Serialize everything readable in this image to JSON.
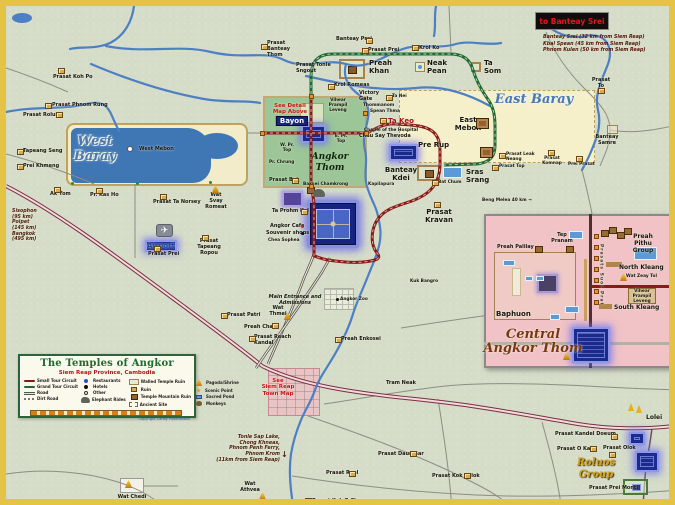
{
  "title": "The Temples of Angkor",
  "colors": {
    "frame": "#e5c345",
    "map_bg": "#d5dcc8",
    "river": "#4d7fc4",
    "baray_water": "#3f76b4",
    "baray_dry": "#f2ecca",
    "thom_green": "#9cc697",
    "highlight_blue": "#1b2a8f",
    "highlight_glow": "#8f97e8",
    "small_circuit": "#8a1a1a",
    "grand_circuit": "#1f6b35",
    "highway": "#7a3040",
    "road": "#8a8f82",
    "inset_pink": "#f1c3c6",
    "legend_green": "#2a6437",
    "red_text": "#cc1515"
  },
  "legend": {
    "title": "The Temples of Angkor",
    "subtitle": "Siem Reap Province, Cambodia",
    "copyright": "Copyright Canby Publications",
    "columns": [
      [
        {
          "i": "line-red",
          "l": "Small Tour Circuit"
        },
        {
          "i": "line-green",
          "l": "Grand Tour Circuit"
        },
        {
          "i": "line-road",
          "l": "Road"
        },
        {
          "i": "line-dirt",
          "l": "Dirt Road"
        }
      ],
      [
        {
          "i": "dot-blue",
          "l": "Restaurants"
        },
        {
          "i": "dot-black",
          "l": "Hotels"
        },
        {
          "i": "circle",
          "l": "Other"
        },
        {
          "i": "eleph",
          "l": "Elephant Rides"
        }
      ],
      [
        {
          "i": "walled",
          "l": "Walled Temple Ruin"
        },
        {
          "i": "ruin",
          "l": "Ruin"
        },
        {
          "i": "temple",
          "l": "Temple Mountain Ruin"
        },
        {
          "i": "site",
          "l": "Ancient Site"
        }
      ],
      [
        {
          "i": "pagoda",
          "l": "Pagoda/Shrine"
        },
        {
          "i": "star",
          "l": "Scenic Point"
        },
        {
          "i": "pond",
          "l": "Sacred Pond"
        },
        {
          "i": "monkey",
          "l": "Monkeys"
        }
      ]
    ]
  },
  "banteay_srei": {
    "title": "to Banteay Srei",
    "notes": [
      "Banteay Srei (32 km from Siem Reap)",
      "Kbal Spean (45 km from Siem Reap)",
      "Phnom Kulen (50 km from Siem Reap)"
    ]
  },
  "map": {
    "labels": [
      {
        "x": 89,
        "y": 128,
        "t": "West\nBaray",
        "c": "region ctr",
        "n": "west-baray-label"
      },
      {
        "x": 528,
        "y": 86,
        "t": "East Baray",
        "c": "region ctr",
        "n": "east-baray-label"
      },
      {
        "x": 324,
        "y": 146,
        "t": "Angkor\nThom",
        "c": "thom ctr",
        "n": "angkor-thom-label"
      },
      {
        "x": 527,
        "y": 322,
        "t": "Central\nAngkor Thom",
        "c": "script ctr",
        "n": "central-angkor-thom-title"
      },
      {
        "x": 590,
        "y": 451,
        "t": "Roluos\nGroup",
        "c": "goldscript ctr",
        "n": "roluos-group-label"
      },
      {
        "x": 286,
        "y": 110,
        "t": "Bayon",
        "c": "chip ctr",
        "n": "bayon-label"
      },
      {
        "x": 284,
        "y": 97,
        "t": "See Detail\nMap Above",
        "c": "red ctr",
        "n": "see-detail-note"
      },
      {
        "x": 272,
        "y": 372,
        "t": "See\nSiem Reap\nTown Map",
        "c": "red ctr",
        "n": "see-town-map-note"
      },
      {
        "x": 382,
        "y": 111,
        "t": "Ta Keo",
        "c": "redbold"
      },
      {
        "x": 363,
        "y": 53,
        "t": "Preah\nKhan",
        "c": "bold"
      },
      {
        "x": 421,
        "y": 53,
        "t": "Neak\nPean",
        "c": "bold"
      },
      {
        "x": 478,
        "y": 53,
        "t": "Ta\nSom",
        "c": "bold"
      },
      {
        "x": 462,
        "y": 110,
        "t": "East\nMebon",
        "c": "bold ctr"
      },
      {
        "x": 412,
        "y": 135,
        "t": "Pre Rup",
        "c": "bold"
      },
      {
        "x": 395,
        "y": 160,
        "t": "Banteay\nKdei",
        "c": "bold ctr"
      },
      {
        "x": 460,
        "y": 162,
        "t": "Sras\nSrang",
        "c": "bold"
      },
      {
        "x": 433,
        "y": 202,
        "t": "Prasat\nKravan",
        "c": "bold ctr"
      },
      {
        "x": 640,
        "y": 408,
        "t": "Lolei",
        "c": "bold6"
      },
      {
        "x": 139,
        "y": 234,
        "t": "Airport",
        "c": "blue"
      },
      {
        "x": 133,
        "y": 141,
        "t": "West Mebon",
        "c": "t5"
      },
      {
        "x": 290,
        "y": 57,
        "t": "Prasat Tonle\nSngout",
        "c": "t5"
      },
      {
        "x": 261,
        "y": 35,
        "t": "Prasat\nBanteay\nThom",
        "c": "t5"
      },
      {
        "x": 330,
        "y": 31,
        "t": "Banteay Prei",
        "c": "t5"
      },
      {
        "x": 362,
        "y": 42,
        "t": "Prasat Prei",
        "c": "t5"
      },
      {
        "x": 413,
        "y": 40,
        "t": "Krol Ko",
        "c": "t5"
      },
      {
        "x": 328,
        "y": 77,
        "t": "Krol Romeas",
        "c": "t5"
      },
      {
        "x": 47,
        "y": 69,
        "t": "Prasat Koh Po",
        "c": "t5"
      },
      {
        "x": 46,
        "y": 97,
        "t": "Prasat Phnom Rung",
        "c": "t5"
      },
      {
        "x": 17,
        "y": 107,
        "t": "Prasat Roluh",
        "c": "t5"
      },
      {
        "x": 17,
        "y": 143,
        "t": "Tapeang Seng",
        "c": "t5"
      },
      {
        "x": 17,
        "y": 158,
        "t": "Prei Khmeng",
        "c": "t5"
      },
      {
        "x": 44,
        "y": 186,
        "t": "Ak Yom",
        "c": "t5"
      },
      {
        "x": 84,
        "y": 187,
        "t": "Pr. Kas Ho",
        "c": "t5"
      },
      {
        "x": 147,
        "y": 194,
        "t": "Prasat Ta Norsey",
        "c": "t5"
      },
      {
        "x": 210,
        "y": 187,
        "t": "Wat\nSvay\nRomeat",
        "c": "t5 ctr"
      },
      {
        "x": 142,
        "y": 246,
        "t": "Prasat Prei",
        "c": "t5"
      },
      {
        "x": 203,
        "y": 233,
        "t": "Prasat\nTapeang\nRopou",
        "c": "t5 ctr"
      },
      {
        "x": 353,
        "y": 85,
        "t": "Victory\nGate",
        "c": "t5"
      },
      {
        "x": 357,
        "y": 97,
        "t": "Thommanom",
        "c": "t45"
      },
      {
        "x": 364,
        "y": 103,
        "t": "Spean Thma",
        "c": "t45"
      },
      {
        "x": 386,
        "y": 88,
        "t": "Ta Nei",
        "c": "t45"
      },
      {
        "x": 358,
        "y": 122,
        "t": "Chapel of the Hospital",
        "c": "t45"
      },
      {
        "x": 353,
        "y": 128,
        "t": "Chau Say Thevoda",
        "c": "t5"
      },
      {
        "x": 332,
        "y": 92,
        "t": "Vihear\nPrampil\nLeveng",
        "c": "t45 ctr"
      },
      {
        "x": 281,
        "y": 137,
        "t": "W. Pr.\nTop",
        "c": "t45 ctr"
      },
      {
        "x": 335,
        "y": 128,
        "t": "E. Pr.\nTop",
        "c": "t45 ctr"
      },
      {
        "x": 263,
        "y": 154,
        "t": "Pr. Chrung",
        "c": "t45"
      },
      {
        "x": 263,
        "y": 172,
        "t": "Prasat Bei",
        "c": "t5"
      },
      {
        "x": 297,
        "y": 176,
        "t": "Baksei Chamkrong",
        "c": "t45"
      },
      {
        "x": 362,
        "y": 176,
        "t": "Kapilapura",
        "c": "t45"
      },
      {
        "x": 266,
        "y": 203,
        "t": "Ta Prohm Kel",
        "c": "t5"
      },
      {
        "x": 264,
        "y": 218,
        "t": "Angkor Cafe",
        "c": "t5"
      },
      {
        "x": 260,
        "y": 225,
        "t": "Souvenir shops",
        "c": "t5"
      },
      {
        "x": 262,
        "y": 232,
        "t": "Chea Sophea",
        "c": "t45"
      },
      {
        "x": 289,
        "y": 289,
        "t": "Main Entrance and\nAdmissions",
        "c": "tinyb ctr"
      },
      {
        "x": 334,
        "y": 291,
        "t": "Angkor Zoo",
        "c": "t45"
      },
      {
        "x": 335,
        "y": 331,
        "t": "Preah Enkosei",
        "c": "t5"
      },
      {
        "x": 404,
        "y": 273,
        "t": "Kuk Bangro",
        "c": "t45"
      },
      {
        "x": 221,
        "y": 307,
        "t": "Prasat Patri",
        "c": "t5"
      },
      {
        "x": 238,
        "y": 319,
        "t": "Preah Chak",
        "c": "t5"
      },
      {
        "x": 272,
        "y": 300,
        "t": "Wat\nThmei",
        "c": "t5 ctr"
      },
      {
        "x": 248,
        "y": 329,
        "t": "Prasat Reach\nKandal",
        "c": "t5"
      },
      {
        "x": 432,
        "y": 174,
        "t": "Bat Chum",
        "c": "t45"
      },
      {
        "x": 476,
        "y": 192,
        "t": "Beng Melea 40 km →",
        "c": "t45"
      },
      {
        "x": 380,
        "y": 375,
        "t": "Tram Neak",
        "c": "t5"
      },
      {
        "x": 372,
        "y": 446,
        "t": "Prasat Daun Sar",
        "c": "t5"
      },
      {
        "x": 426,
        "y": 468,
        "t": "Prasat Kok Thlok",
        "c": "t5"
      },
      {
        "x": 320,
        "y": 465,
        "t": "Prasat Reel",
        "c": "t5"
      },
      {
        "x": 244,
        "y": 476,
        "t": "Wat\nAthvea",
        "c": "t5 ctr"
      },
      {
        "x": 306,
        "y": 493,
        "t": "Prasat Kuk O Chrung",
        "c": "t5"
      },
      {
        "x": 126,
        "y": 489,
        "t": "Wat Chedi",
        "c": "t5 ctr"
      },
      {
        "x": 595,
        "y": 72,
        "t": "Prasat\nTo",
        "c": "t5 ctr"
      },
      {
        "x": 601,
        "y": 129,
        "t": "Banteay\nSamre",
        "c": "t5 ctr"
      },
      {
        "x": 500,
        "y": 146,
        "t": "Prasat Leak\nNeang",
        "c": "t45"
      },
      {
        "x": 493,
        "y": 158,
        "t": "Prasat Top",
        "c": "t45"
      },
      {
        "x": 546,
        "y": 150,
        "t": "Prasat\nKomnap",
        "c": "t45 ctr"
      },
      {
        "x": 562,
        "y": 156,
        "t": "Prei Prasat",
        "c": "t45"
      },
      {
        "x": 549,
        "y": 426,
        "t": "Prasat Kandel Doeum",
        "c": "t5"
      },
      {
        "x": 551,
        "y": 441,
        "t": "Prasat O Kaek",
        "c": "t5"
      },
      {
        "x": 597,
        "y": 440,
        "t": "Prasat Olok",
        "c": "t5"
      },
      {
        "x": 583,
        "y": 480,
        "t": "Prasat Prei Monti",
        "c": "t5"
      },
      {
        "x": 556,
        "y": 227,
        "t": "Tep\nPranam",
        "c": "t5 ctr"
      },
      {
        "x": 491,
        "y": 239,
        "t": "Preah Palilay",
        "c": "t5"
      },
      {
        "x": 637,
        "y": 227,
        "t": "Preah\nPithu Group",
        "c": "bold6 ctr"
      },
      {
        "x": 613,
        "y": 258,
        "t": "North Kleang",
        "c": "bold6"
      },
      {
        "x": 620,
        "y": 268,
        "t": "Wat Zeay Tol",
        "c": "t45"
      },
      {
        "x": 636,
        "y": 283,
        "t": "Vihear\nPrampil\nLeveng",
        "c": "t45 ctr"
      },
      {
        "x": 608,
        "y": 298,
        "t": "South Kleang",
        "c": "bold6"
      },
      {
        "x": 490,
        "y": 304,
        "t": "Baphuon",
        "c": "bold"
      },
      {
        "x": 592,
        "y": 238,
        "t": "Prasats Suor Prat",
        "c": "vert"
      },
      {
        "x": 6,
        "y": 203,
        "t": "Sisophon\n(95 km)\nPoipet\n(145 km)\nBangkok\n(495 km)",
        "c": "note"
      },
      {
        "x": 274,
        "y": 429,
        "t": "Tonle Sap Lake,\nChong Khneas,\nPhnom Penh Ferry,\nPhnom Krom\n(11km from Siem Reap)",
        "c": "note ralign"
      }
    ],
    "icons": [
      {
        "x": 52,
        "y": 62,
        "t": "r"
      },
      {
        "x": 39,
        "y": 97,
        "t": "r"
      },
      {
        "x": 50,
        "y": 106,
        "t": "r"
      },
      {
        "x": 11,
        "y": 143,
        "t": "r"
      },
      {
        "x": 11,
        "y": 158,
        "t": "r"
      },
      {
        "x": 48,
        "y": 181,
        "t": "r"
      },
      {
        "x": 90,
        "y": 182,
        "t": "r"
      },
      {
        "x": 154,
        "y": 188,
        "t": "r"
      },
      {
        "x": 148,
        "y": 240,
        "t": "r"
      },
      {
        "x": 196,
        "y": 229,
        "t": "r"
      },
      {
        "x": 255,
        "y": 38,
        "t": "r"
      },
      {
        "x": 360,
        "y": 32,
        "t": "r"
      },
      {
        "x": 356,
        "y": 42,
        "t": "r"
      },
      {
        "x": 406,
        "y": 39,
        "t": "r"
      },
      {
        "x": 322,
        "y": 78,
        "t": "r"
      },
      {
        "x": 286,
        "y": 172,
        "t": "r"
      },
      {
        "x": 374,
        "y": 112,
        "t": "r"
      },
      {
        "x": 380,
        "y": 89,
        "t": "r"
      },
      {
        "x": 295,
        "y": 203,
        "t": "r"
      },
      {
        "x": 215,
        "y": 307,
        "t": "r"
      },
      {
        "x": 266,
        "y": 317,
        "t": "r"
      },
      {
        "x": 243,
        "y": 330,
        "t": "r"
      },
      {
        "x": 329,
        "y": 331,
        "t": "r"
      },
      {
        "x": 426,
        "y": 174,
        "t": "r"
      },
      {
        "x": 486,
        "y": 159,
        "t": "r"
      },
      {
        "x": 493,
        "y": 147,
        "t": "r"
      },
      {
        "x": 542,
        "y": 144,
        "t": "r"
      },
      {
        "x": 570,
        "y": 150,
        "t": "r"
      },
      {
        "x": 592,
        "y": 82,
        "t": "r"
      },
      {
        "x": 404,
        "y": 445,
        "t": "r"
      },
      {
        "x": 458,
        "y": 467,
        "t": "r"
      },
      {
        "x": 343,
        "y": 465,
        "t": "r"
      },
      {
        "x": 299,
        "y": 492,
        "t": "r"
      },
      {
        "x": 605,
        "y": 428,
        "t": "r"
      },
      {
        "x": 584,
        "y": 440,
        "t": "r"
      },
      {
        "x": 603,
        "y": 446,
        "t": "r"
      },
      {
        "x": 428,
        "y": 196,
        "t": "r"
      },
      {
        "x": 470,
        "y": 112,
        "t": "t"
      },
      {
        "x": 474,
        "y": 141,
        "t": "t"
      },
      {
        "x": 301,
        "y": 181,
        "t": "t2"
      },
      {
        "x": 529,
        "y": 240,
        "t": "t2"
      },
      {
        "x": 560,
        "y": 240,
        "t": "t2"
      },
      {
        "x": 595,
        "y": 224,
        "t": "t2"
      },
      {
        "x": 603,
        "y": 221,
        "t": "t2"
      },
      {
        "x": 611,
        "y": 226,
        "t": "t2"
      },
      {
        "x": 618,
        "y": 222,
        "t": "t2"
      },
      {
        "x": 601,
        "y": 119,
        "t": "w2"
      },
      {
        "x": 206,
        "y": 179,
        "t": "p"
      },
      {
        "x": 278,
        "y": 306,
        "t": "p"
      },
      {
        "x": 614,
        "y": 267,
        "t": "p"
      },
      {
        "x": 119,
        "y": 474,
        "t": "p"
      },
      {
        "x": 253,
        "y": 486,
        "t": "p"
      },
      {
        "x": 557,
        "y": 346,
        "t": "p"
      },
      {
        "x": 622,
        "y": 397,
        "t": "s2"
      },
      {
        "x": 630,
        "y": 399,
        "t": "s2"
      },
      {
        "x": 150,
        "y": 218,
        "t": "plane",
        "g": "✈"
      },
      {
        "x": 307,
        "y": 183,
        "t": "e"
      },
      {
        "x": 295,
        "y": 226,
        "t": "d"
      },
      {
        "x": 330,
        "y": 292,
        "t": "d"
      },
      {
        "x": 359,
        "y": 105,
        "t": "d"
      },
      {
        "x": 295,
        "y": 219,
        "t": "dr"
      },
      {
        "x": 65,
        "y": 176,
        "t": "dg"
      },
      {
        "x": 130,
        "y": 176,
        "t": "dg"
      },
      {
        "x": 203,
        "y": 175,
        "t": "dg"
      },
      {
        "x": 303,
        "y": 88,
        "t": "g"
      },
      {
        "x": 303,
        "y": 178,
        "t": "g"
      },
      {
        "x": 254,
        "y": 125,
        "t": "g"
      },
      {
        "x": 358,
        "y": 125,
        "t": "g"
      },
      {
        "x": 357,
        "y": 105,
        "t": "g"
      },
      {
        "x": 588,
        "y": 228,
        "t": "g"
      },
      {
        "x": 588,
        "y": 239,
        "t": "g"
      },
      {
        "x": 588,
        "y": 250,
        "t": "g"
      },
      {
        "x": 588,
        "y": 261,
        "t": "g"
      },
      {
        "x": 588,
        "y": 272,
        "t": "g"
      },
      {
        "x": 588,
        "y": 283,
        "t": "g"
      },
      {
        "x": 588,
        "y": 294,
        "t": "g"
      },
      {
        "x": 275,
        "y": 444,
        "t": "ar",
        "g": "↓"
      },
      {
        "x": 121,
        "y": 140,
        "t": "wd"
      }
    ]
  }
}
